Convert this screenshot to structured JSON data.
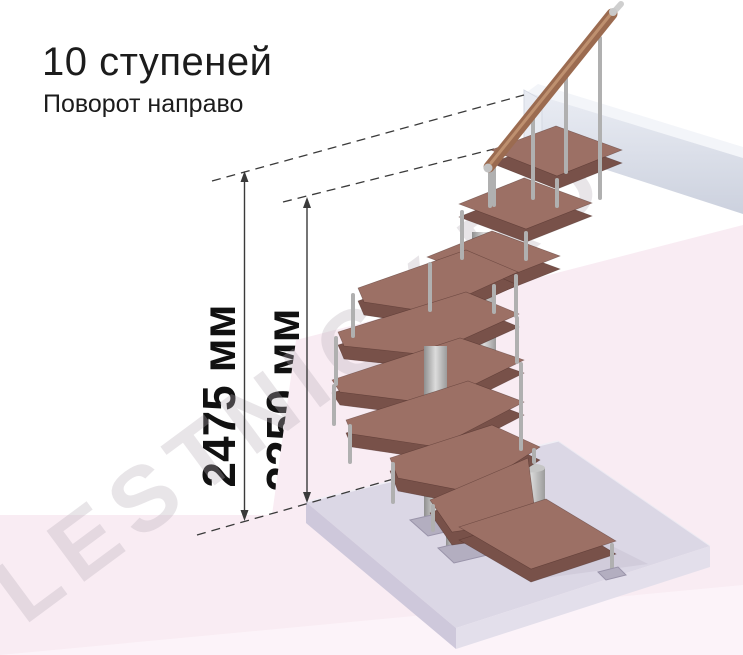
{
  "title": "10 ступеней",
  "subtitle": "Поворот направо",
  "dimension_labels": {
    "total_height": "2475 мм",
    "flight_height": "2250 мм"
  },
  "watermark": "LESTNICY.RU",
  "diagram": {
    "type": "staircase-dimension-diagram",
    "steps_count": 10,
    "turn_direction": "направо",
    "total_height_mm": 2475,
    "upper_flight_height_mm": 2250
  },
  "colors": {
    "tread_top": "#9c7065",
    "tread_side": "#785149",
    "handrail_wood": "#9b6b50",
    "metal": "#b3b3b3",
    "floor_slab": "#dbd7e5",
    "landing_slab": "#e9ecf3",
    "background_pink": "#f9ecf3",
    "dimension_line": "#3a3a3a",
    "text": "#1c1c1c"
  }
}
